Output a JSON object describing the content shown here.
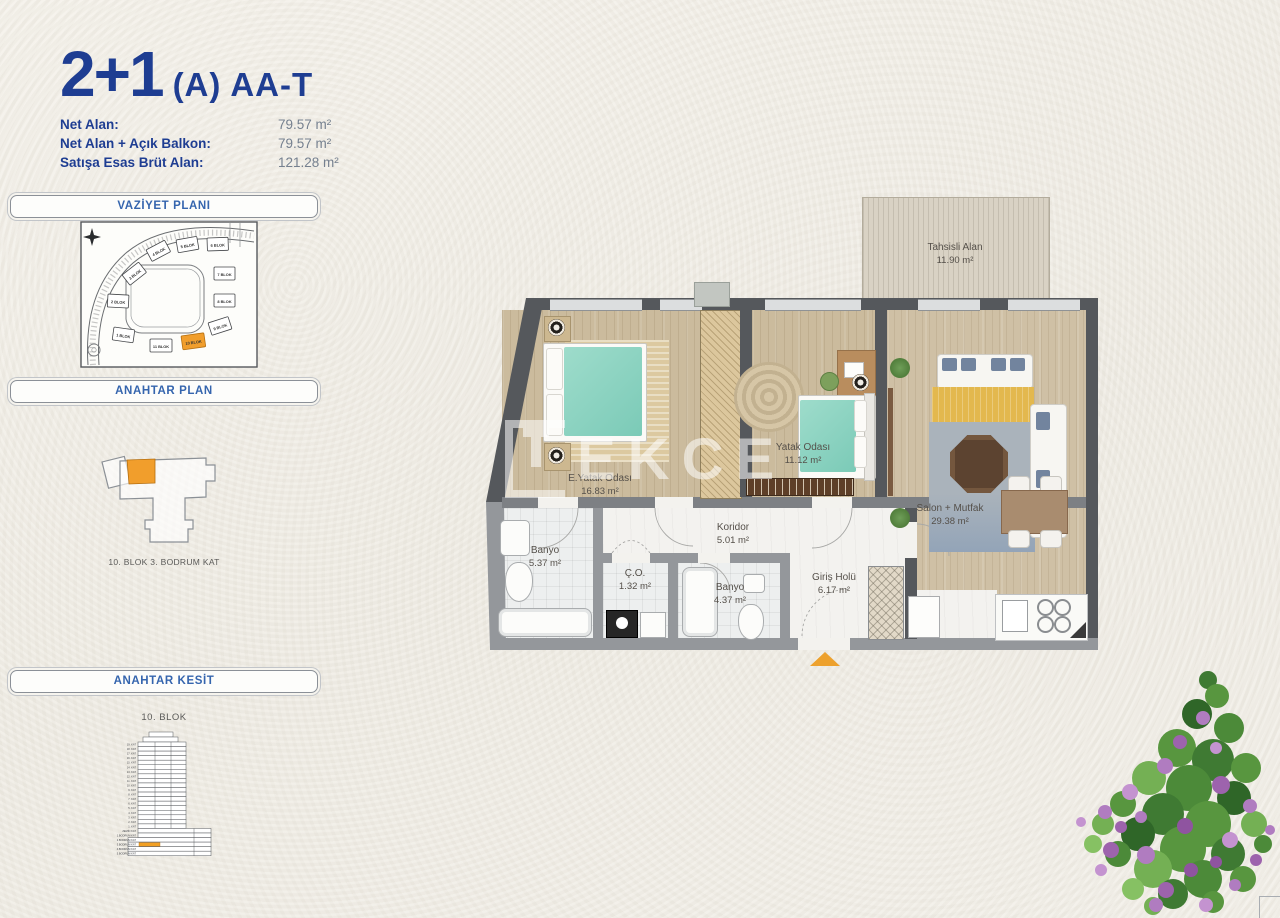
{
  "page": {
    "title_number": "2+1",
    "title_suffix": "(A) AA-T"
  },
  "info": {
    "rows": [
      {
        "label": "Net Alan:",
        "value": "79.57 m²"
      },
      {
        "label": "Net Alan + Açık Balkon:",
        "value": "79.57 m²"
      },
      {
        "label": "Satışa Esas Brüt Alan:",
        "value": "121.28 m²"
      }
    ]
  },
  "sections": {
    "site_plan_title": "VAZİYET PLANI",
    "key_plan_title": "ANAHTAR PLAN",
    "key_section_title": "ANAHTAR KESİT"
  },
  "site_plan": {
    "blocks": [
      "1 BLOK",
      "2 BLOK",
      "3 BLOK",
      "4 BLOK",
      "5 BLOK",
      "6 BLOK",
      "7 BLOK",
      "8 BLOK",
      "9 BLOK",
      "10 BLOK",
      "11 BLOK"
    ],
    "highlighted_block": "10 BLOK"
  },
  "key_plan": {
    "caption": "10. BLOK 3. BODRUM KAT"
  },
  "key_section": {
    "caption": "10. BLOK",
    "floors": [
      "19. KAT",
      "18. KAT",
      "17. KAT",
      "16. KAT",
      "15. KAT",
      "14. KAT",
      "13. KAT",
      "12. KAT",
      "11. KAT",
      "10. KAT",
      "9. KAT",
      "8. KAT",
      "7. KAT",
      "6. KAT",
      "5. KAT",
      "4. KAT",
      "3. KAT",
      "2. KAT",
      "1. KAT",
      "ZEMİN KAT",
      "1.BODRUM KAT",
      "2.BODRUM KAT",
      "3.BODRUM KAT",
      "4.BODRUM KAT",
      "5.BODRUM KAT"
    ],
    "highlighted_floor": "3.BODRUM KAT"
  },
  "floor_plan": {
    "rooms": {
      "tahsisli": {
        "name": "Tahsisli Alan",
        "area": "11.90 m²"
      },
      "master_bedroom": {
        "name": "E.Yatak Odası",
        "area": "16.83 m²"
      },
      "bedroom": {
        "name": "Yatak Odası",
        "area": "11.12 m²"
      },
      "living_kitchen": {
        "name": "Salon + Mutfak",
        "area": "29.38 m²"
      },
      "corridor": {
        "name": "Koridor",
        "area": "5.01 m²"
      },
      "bathroom_1": {
        "name": "Banyo",
        "area": "5.37 m²"
      },
      "laundry": {
        "name": "Ç.O.",
        "area": "1.32 m²"
      },
      "bathroom_2": {
        "name": "Banyo",
        "area": "4.37 m²"
      },
      "entrance_hall": {
        "name": "Giriş Holü",
        "area": "6.17 m²"
      }
    }
  },
  "watermark": {
    "text": "TEKCE"
  },
  "colors": {
    "accent_blue": "#1e3d92",
    "header_blue": "#3565ae",
    "highlight_orange": "#f19e2c",
    "entrance_arrow_orange": "#eda12d",
    "wall_dark": "#55585c",
    "wall_light": "#94979b"
  }
}
